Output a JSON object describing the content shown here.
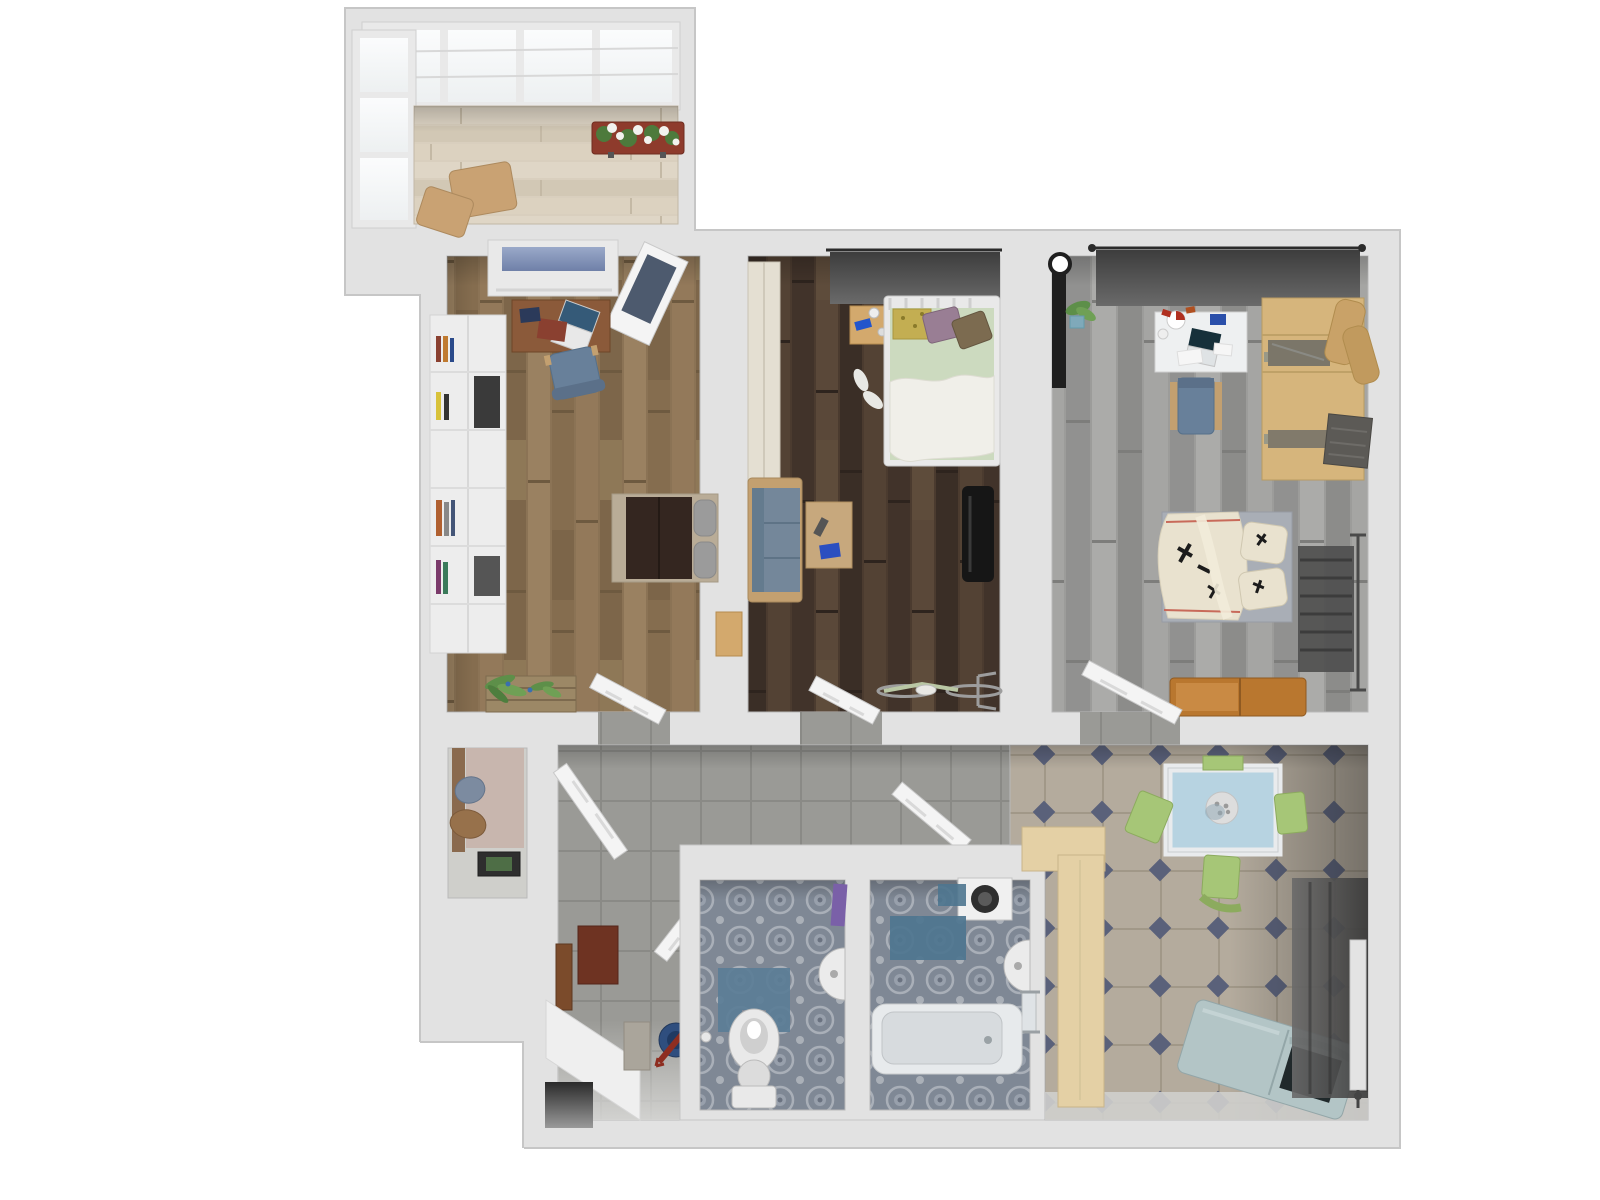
{
  "canvas": {
    "width": 1600,
    "height": 1200,
    "view": "top-down 3d floor plan render, no text labels"
  },
  "colors": {
    "background": "#ffffff",
    "wall": "#e2e2e2",
    "wall_edge": "#c6c6c6",
    "threshold": "#d8d8d8",
    "door_leaf": "#f4f4f4",
    "door_edge": "#c9c9c9",
    "glass_frame": "#e9e9e9",
    "window_glass_blue": "#8c9cc0",
    "balcony_floor": "#d9cfbe",
    "flower_box": "#8e3b2c",
    "flower_white": "#f2f2ee",
    "flower_leaf": "#4d7a3c",
    "ottoman_tan": "#c9a273",
    "floor_study": "#8b7355",
    "floor_bedroom": "#4b3b2f",
    "floor_gray_room": "#9c9c9a",
    "hall_tile": "#9a9a96",
    "bath_tile": "#7f8895",
    "kitchen_tile": "#b4ab9d",
    "kitchen_tile_dot": "#5a617a",
    "curtain_dark": "#555555",
    "curtain_rod": "#2b2b2b",
    "shelf_white": "#ededed",
    "desk_wood": "#8b5a3a",
    "chair_blue": "#68809a",
    "chair_wood": "#c3a070",
    "laptop_dark": "#355a78",
    "laptop_base": "#e8e8e8",
    "book_red": "#8a4030",
    "tablet_dark": "#2b3a5a",
    "bed_dark_blanket": "#342620",
    "bed_gray_pillow": "#9b9b9b",
    "bed_frame_light": "#b9ac97",
    "crate_wood": "#9c8866",
    "plant_green": "#5d8f49",
    "sofa_blue": "#74879a",
    "sofa_back_blue": "#647b8e",
    "coffee_table": "#c7a87d",
    "tv_black": "#161616",
    "bike_frame": "#b9c7a4",
    "bike_metal": "#9d9d9d",
    "wardrobe_cream": "#e4dfd2",
    "nightstand_wood": "#d3a96d",
    "phone_blue": "#2255cc",
    "bed2_frame_white": "#e9e9e9",
    "bed2_green": "#ccdabf",
    "bed2_white": "#f0efe9",
    "pillow_yellow": "#c3ae52",
    "pillow_purple": "#997e94",
    "pillow_brown": "#7c6b50",
    "shoe_white": "#e8e8e4",
    "desk_white": "#eef0f1",
    "wardrobe_tan": "#d6b57c",
    "wardrobe_glass": "#6b6b66",
    "beanbag_tan": "#c9a268",
    "textile_dark": "#5c5a56",
    "bed3_sheet_gray": "#a9aeb6",
    "bed3_blanket_cream": "#e9e2cf",
    "print_black": "#1c1c1c",
    "piping_red": "#c86a5a",
    "radiator_dark": "#4f4f4f",
    "bench_wood": "#b9772f",
    "lamp_black": "#1f1f1f",
    "pot_blue": "#7fa9ba",
    "closet_back": "#c8b6ae",
    "closet_rod_wood": "#8a6a4e",
    "coat_blue": "#7c8ba0",
    "coat_brown": "#97714b",
    "closet_mat_dark": "#2e2e2e",
    "closet_mat_green": "#4e6e46",
    "hall_mat_brown": "#6e3322",
    "hall_door_brown": "#7b4b2b",
    "hall_box_gray": "#aaa59b",
    "bucket_blue": "#2f4e7e",
    "umbrella_red": "#8e2d20",
    "bench_white": "#efefef",
    "entry_dark": "#3a3a3a",
    "toilet_white": "#e9e9e9",
    "wc_mat_blue": "#5b7d96",
    "towel_purple": "#7a60a8",
    "sink_white": "#ebebeb",
    "washer_white": "#f0f0f0",
    "washer_drum": "#2f2f2f",
    "bath_mat_blue": "#4e758f",
    "tub_white": "#e7eaec",
    "tub_inner": "#d7dbde",
    "table_frame_white": "#e9ebed",
    "table_top_blue": "#b7d3e1",
    "plate_white": "#dddddd",
    "chair_green": "#a6c677",
    "counter_wood": "#e4d0a5",
    "teal_bench": "#b3c5c6",
    "teal_bench_open": "#20292b",
    "radiator_white": "#e3e3e3"
  },
  "rooms": [
    {
      "id": "balcony",
      "label": "glazed balcony",
      "items": [
        "skylight glazing",
        "window wall",
        "flower box with white flowers",
        "two tan ottomans",
        "light wood floor"
      ]
    },
    {
      "id": "study",
      "label": "study room",
      "items": [
        "window",
        "white wall shelf with books",
        "wooden desk with laptop and books",
        "blue desk chair",
        "daybed with dark blanket and gray pillows",
        "plant crate",
        "leaning balcony door",
        "open door"
      ]
    },
    {
      "id": "bedroom",
      "label": "middle bedroom",
      "items": [
        "dark wood floor",
        "window curtain",
        "cream wardrobe",
        "nightstand with phone",
        "white metal bed with green bedding and pillows",
        "slippers",
        "blue sofa",
        "coffee table",
        "wall tv",
        "bicycle",
        "open door"
      ]
    },
    {
      "id": "gray-bedroom",
      "label": "right bedroom",
      "items": [
        "gray plank floor",
        "window curtain",
        "floor lamp",
        "potted plant",
        "white desk with laptop and stationery",
        "desk chair",
        "tan wardrobe with glass doors",
        "tan lounge chair",
        "folded dark textiles",
        "bed with calligraphy print bedding",
        "dark towel radiator",
        "wooden bench",
        "open door"
      ]
    },
    {
      "id": "closet",
      "label": "entry closet niche",
      "items": [
        "hanging blue coat",
        "hanging brown coat",
        "dark floor mat"
      ]
    },
    {
      "id": "hallway",
      "label": "hallway",
      "items": [
        "gray tile floor",
        "closet door",
        "brown door mat",
        "brown wall door",
        "white partition bench",
        "gray box",
        "blue bucket with red umbrella",
        "dark entry niche"
      ]
    },
    {
      "id": "wc",
      "label": "toilet room",
      "items": [
        "patterned blue-gray tile",
        "toilet",
        "blue toilet mat",
        "wall sink",
        "purple towel",
        "open door"
      ]
    },
    {
      "id": "bathroom",
      "label": "bathroom",
      "items": [
        "patterned blue-gray tile",
        "washing machine",
        "blue bath mats",
        "wall sink",
        "towel rail",
        "bathtub",
        "open door"
      ]
    },
    {
      "id": "kitchen",
      "label": "kitchen",
      "items": [
        "octagon tile floor with blue dots",
        "blue-top dining table with plate",
        "four green chairs",
        "light wood counter",
        "teal storage bench with open lid",
        "dark curtain",
        "white radiator"
      ]
    }
  ]
}
